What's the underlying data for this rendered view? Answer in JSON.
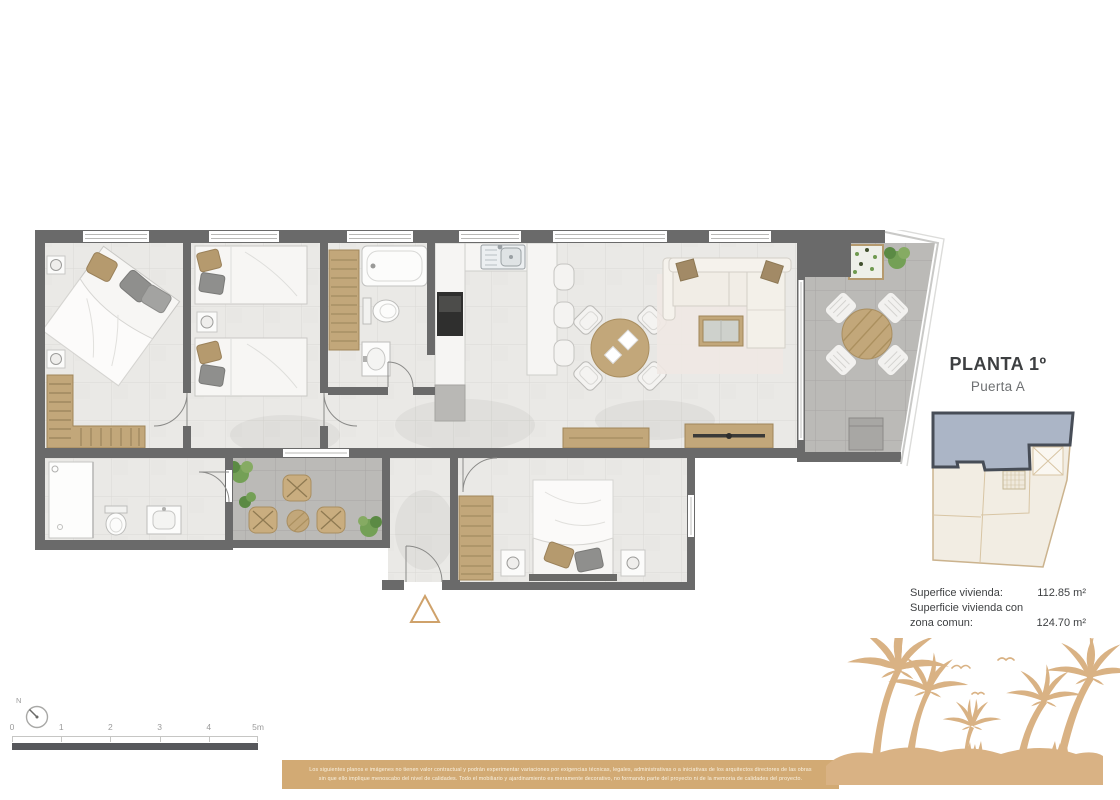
{
  "plan_label": {
    "title": "PLANTA 1º",
    "subtitle": "Puerta A"
  },
  "area_summary": {
    "rows": [
      {
        "label": "Superfice vivienda:",
        "value": "112.85 m²"
      },
      {
        "label": "Superficie vivienda con",
        "value": ""
      },
      {
        "label": "zona comun:",
        "value": "124.70 m²"
      }
    ]
  },
  "scale_bar": {
    "labels": [
      "0",
      "1",
      "2",
      "3",
      "4",
      "5m"
    ]
  },
  "compass": {
    "label": "N"
  },
  "disclaimer": {
    "line1": "Los siguientes planos e imágenes no tienen valor contractual y podrán experimentar variaciones por exigencias técnicas, legales, administrativas o a iniciativas de los arquitectos directores de las obras",
    "line2": "sin que ello implique menoscabo del nivel de calidades. Todo el mobiliario y ajardinamiento es meramente decorativo, no formando parte del proyecto ni de la memoria de calidades del proyecto."
  },
  "colors": {
    "wall": "#6a6a6a",
    "interior_floor": "#eae9e6",
    "terrace_floor": "#bbbab7",
    "wood_furniture": "#c2a77a",
    "banner": "#d2aa74",
    "palm_silhouette": "#d9b284",
    "keyplan_highlight": "#abb5c6",
    "keyplan_outline": "#cbb38e",
    "entry_marker": "#cfa26b",
    "plant_green": "#74a056"
  }
}
